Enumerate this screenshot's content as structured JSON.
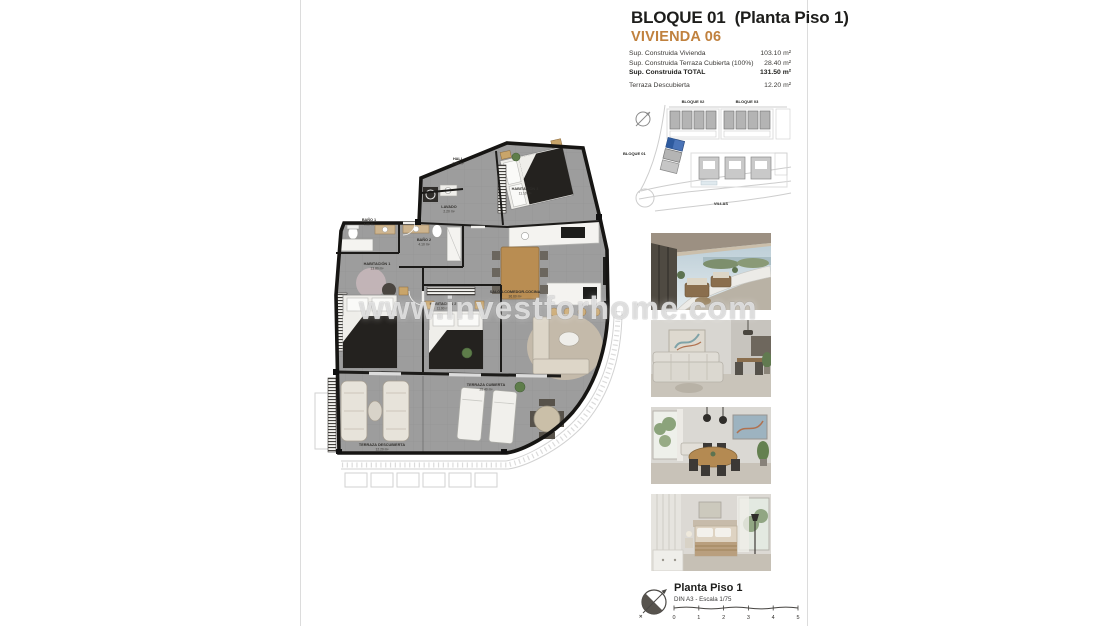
{
  "document": {
    "title_block": "BLOQUE 01",
    "title_floor": "(Planta Piso 1)",
    "unit": "VIVIENDA 06"
  },
  "surface_table": {
    "rows": [
      {
        "label": "Sup. Construida Vivienda",
        "value": "103.10 m²"
      },
      {
        "label": "Sup. Construida Terraza Cubierta (100%)",
        "value": "28.40 m²"
      },
      {
        "label": "Sup. Construida TOTAL",
        "value": "131.50 m²"
      },
      {
        "label": "Terraza Descubierta",
        "value": "12.20 m²"
      }
    ]
  },
  "site_map": {
    "labels": {
      "bloque01": "BLOQUE 01",
      "bloque02": "BLOQUE 02",
      "bloque03": "BLOQUE 03",
      "villas": "VILLAS"
    },
    "highlight_color": "#4a74b8"
  },
  "floor_plan": {
    "rooms": [
      {
        "name": "HALL",
        "area": "2.80 m²"
      },
      {
        "name": "LAVADO",
        "area": "2.20 m²"
      },
      {
        "name": "HABITACIÓN 3",
        "area": "11.10 m²"
      },
      {
        "name": "BAÑO 1",
        "area": "4.00 m²"
      },
      {
        "name": "BAÑO 2",
        "area": "4.10 m²"
      },
      {
        "name": "HABITACIÓN 1",
        "area": "13.80 m²"
      },
      {
        "name": "HABITACIÓN 2",
        "area": "11.90 m²"
      },
      {
        "name": "SALÓN-COMEDOR-COCINA",
        "area": "36.60 m²"
      },
      {
        "name": "TERRAZA CUBIERTA",
        "area": "28.40 m²"
      },
      {
        "name": "TERRAZA DESCUBIERTA",
        "area": "12.20 m²"
      }
    ]
  },
  "photos": [
    {
      "name": "terrace-exterior-view"
    },
    {
      "name": "living-room-sofa"
    },
    {
      "name": "dining-area"
    },
    {
      "name": "bedroom"
    }
  ],
  "watermark": "www.investforhome.com",
  "footer": {
    "plan_name": "Planta Piso 1",
    "scale_note": "DIN A3 - Escala 1/75",
    "scale_ticks": [
      "0",
      "1",
      "2",
      "3",
      "4",
      "5"
    ]
  },
  "colors": {
    "accent_orange": "#c0813e",
    "plan_gray": "#9d9d9d",
    "highlight_blue": "#4a74b8"
  }
}
